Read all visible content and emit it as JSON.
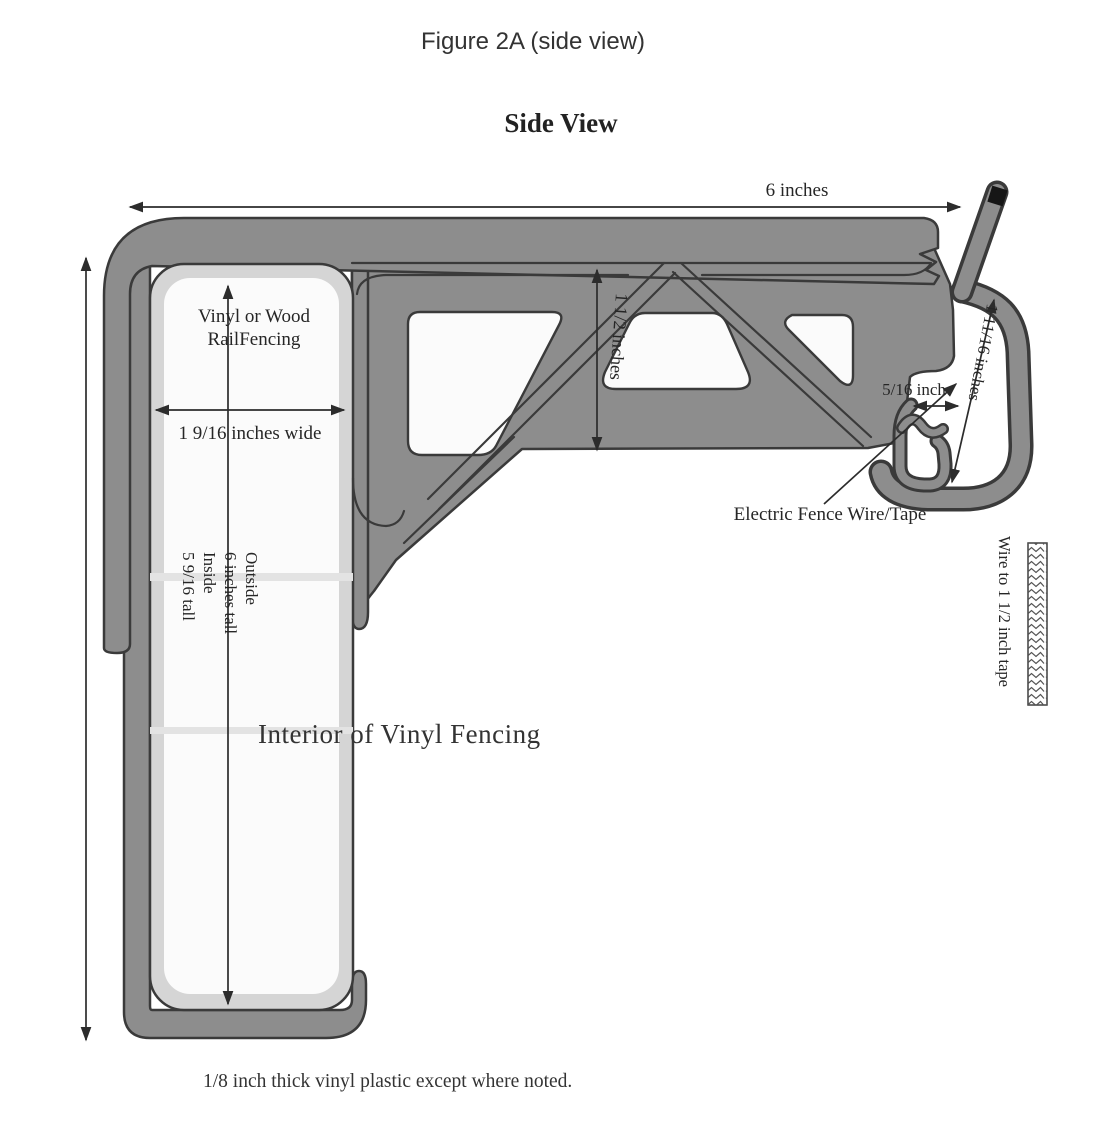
{
  "figure": {
    "caption": "Figure 2A (side view)",
    "heading": "Side View",
    "footnote": "1/8 inch thick vinyl plastic except where noted."
  },
  "labels": {
    "rail_line1": "Vinyl or Wood",
    "rail_line2": "RailFencing",
    "interior": "Interior of Vinyl Fencing",
    "electric_wire": "Electric Fence Wire/Tape",
    "wire_tape": "Wire to 1 1/2 inch tape"
  },
  "dimensions": {
    "overall_width": "6 inches",
    "rail_width": "1 9/16 inches wide",
    "web_height": "1 1/2 inches",
    "wire_slot": "5/16 inch",
    "hook_slot": "1 11/16 inches",
    "height_lines": [
      "Outside",
      "6 inches tall",
      "Inside",
      "5 9/16 tall"
    ]
  },
  "colors": {
    "body_gray": "#8d8d8d",
    "outline": "#3a3a3a",
    "liner": "#d5d5d5",
    "interior_white": "#fbfbfb",
    "arm_tip_black": "#161616"
  }
}
